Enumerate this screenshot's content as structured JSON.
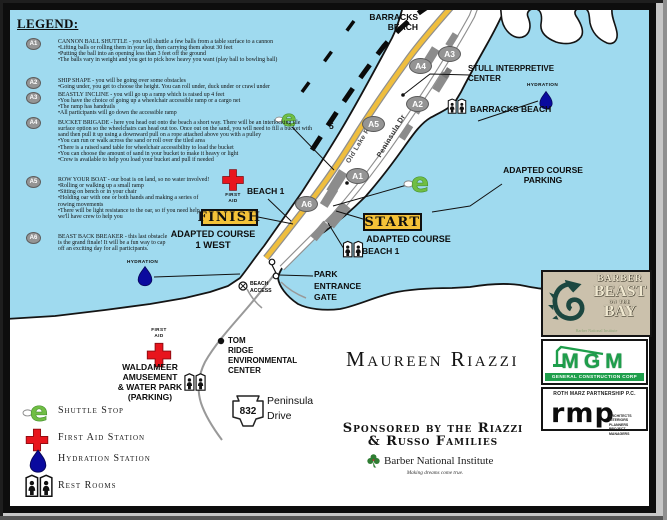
{
  "legend": {
    "title": "LEGEND:",
    "items": [
      {
        "badge": "A1",
        "title": "CANNON BALL SHUTTLE - you will shuttle a few balls from a table surface to a cannon",
        "bullets": [
          "•Lifting balls or rolling them in your lap, then carrying them about 30 feet",
          "•Putting the ball into an opening less than 3 feet off the ground",
          "•The balls vary in weight and you get to pick how heavy you want (play ball to bowling ball)"
        ]
      },
      {
        "badge": "A2",
        "title": "SHIP SHAPE - you will be going over some obstacles",
        "bullets": [
          "•Going under, you get to choose the height.  You can roll under, duck under or crawl under"
        ]
      },
      {
        "badge": "A3",
        "title": "BEASTLY INCLINE - you will go up a ramp which is raised up 4 feet",
        "bullets": [
          "•You have the choice of going up a wheelchair accessible ramp or a cargo net",
          "•The ramp has handrails",
          "•All participants will go down the accessible ramp"
        ]
      },
      {
        "badge": "A4",
        "title": "BUCKET BRIGADE - here you head out onto the beach a short way.  There will be an interlocking tile surface option so the wheelchairs can head out too.  Once out on the sand, you will need to fill a bucket with sand then pull it up using a downward pull on a rope attached above you with a pulley",
        "bullets": [
          "•You can run or walk across the sand or roll over the tiled area",
          "•There is a raised sand table for wheelchair accessibility to load the bucket",
          "•You can choose the amount of sand in your bucket to make it heavy or light",
          "•Crew is available to help you load your bucket and pull if needed"
        ]
      },
      {
        "badge": "A5",
        "title": "ROW YOUR BOAT - our boat is on land, so no water involved!",
        "bullets": [
          "•Rolling or walking up a small ramp",
          "•Sitting on bench or in your chair",
          "•Holding oar with one or both hands and making a series of rowing movements",
          "•There will be light resistance to the oar, so if you need help, we'll have crew to help you"
        ]
      },
      {
        "badge": "A6",
        "title": "BEAST BACK BREAKER - this last obstacle is the grand finale!  It will be a fun way to cap off an exciting day for all participants.",
        "bullets": []
      }
    ]
  },
  "map": {
    "course_markers": [
      "A1",
      "A2",
      "A3",
      "A4",
      "A5",
      "A6"
    ],
    "mile_marker": "5",
    "roads": {
      "old_lake": "Old Lake Road",
      "peninsula_dr": "Peninsula Dr"
    },
    "labels": {
      "barracks_top_1": "BARRACKS",
      "barracks_top_2": "BEACH",
      "stull_1": "STULL INTERPRETIVE",
      "stull_2": "CENTER",
      "hydration": "HYDRATION",
      "barracks_shore": "BARRACKS BEACH",
      "parking_1": "ADAPTED COURSE",
      "parking_2": "PARKING",
      "start": "START",
      "start_sub": "ADAPTED COURSE",
      "finish": "FINISH",
      "finish_sub": "ADAPTED COURSE",
      "finish_sub2": "1 WEST",
      "beach1": "BEACH 1",
      "first_aid_1": "FIRST",
      "first_aid_2": "AID",
      "beach1_lower": "BEACH 1",
      "gate_1": "PARK",
      "gate_2": "ENTRANCE",
      "gate_3": "GATE",
      "access_1": "BEACH",
      "access_2": "ACCESS",
      "hydration_w": "HYDRATION",
      "tom_1": "TOM",
      "tom_2": "RIDGE",
      "tom_3": "ENVIRONMENTAL",
      "tom_4": "CENTER",
      "wald_1": "WALDAMEER",
      "wald_2": "AMUSEMENT",
      "wald_3": "& WATER PARK",
      "wald_4": "(PARKING)",
      "wald_aid_1": "FIRST",
      "wald_aid_2": "AID",
      "route_num": "832",
      "route_1": "Peninsula",
      "route_2": "Drive"
    }
  },
  "center": {
    "athlete_name": "Maureen Riazzi",
    "sponsored_1": "Sponsored by the Riazzi",
    "sponsored_2": "& Russo Families",
    "institute": "Barber National Institute",
    "tagline": "Making dreams come true."
  },
  "key": {
    "items": [
      {
        "icon": "shuttle-stop-icon",
        "label": "Shuttle Stop"
      },
      {
        "icon": "first-aid-icon",
        "label": "First Aid Station"
      },
      {
        "icon": "hydration-icon",
        "label": "Hydration Station"
      },
      {
        "icon": "restroom-icon",
        "label": "Rest Rooms"
      }
    ]
  },
  "logos": {
    "beast": {
      "line1": "BARBER",
      "line2": "BEAST",
      "mid": "ON THE",
      "line3": "BAY",
      "sub": "Barber National Institute"
    },
    "mgm": {
      "name": "MGM",
      "sub": "GENERAL CONSTRUCTION CORP"
    },
    "rmp": {
      "top": "ROTH MARZ PARTNERSHIP P.C.",
      "name": "rmp",
      "services_1": "ARCHITECTS",
      "services_2": "INTERIORS",
      "services_3": "PLANNERS",
      "services_4": "PROJECT MANAGERS"
    }
  },
  "icons": {
    "shuttle_glyph": "e"
  },
  "colors": {
    "water": "#9FDAEF",
    "land": "#FFFFFF",
    "road_yellow": "#EFBE3E",
    "highlight": "#F4C238",
    "marker_gray": "#949494",
    "shuttle_green": "#70BE44",
    "aid_red": "#E8151D",
    "hydration_blue": "#0A0A9E"
  }
}
